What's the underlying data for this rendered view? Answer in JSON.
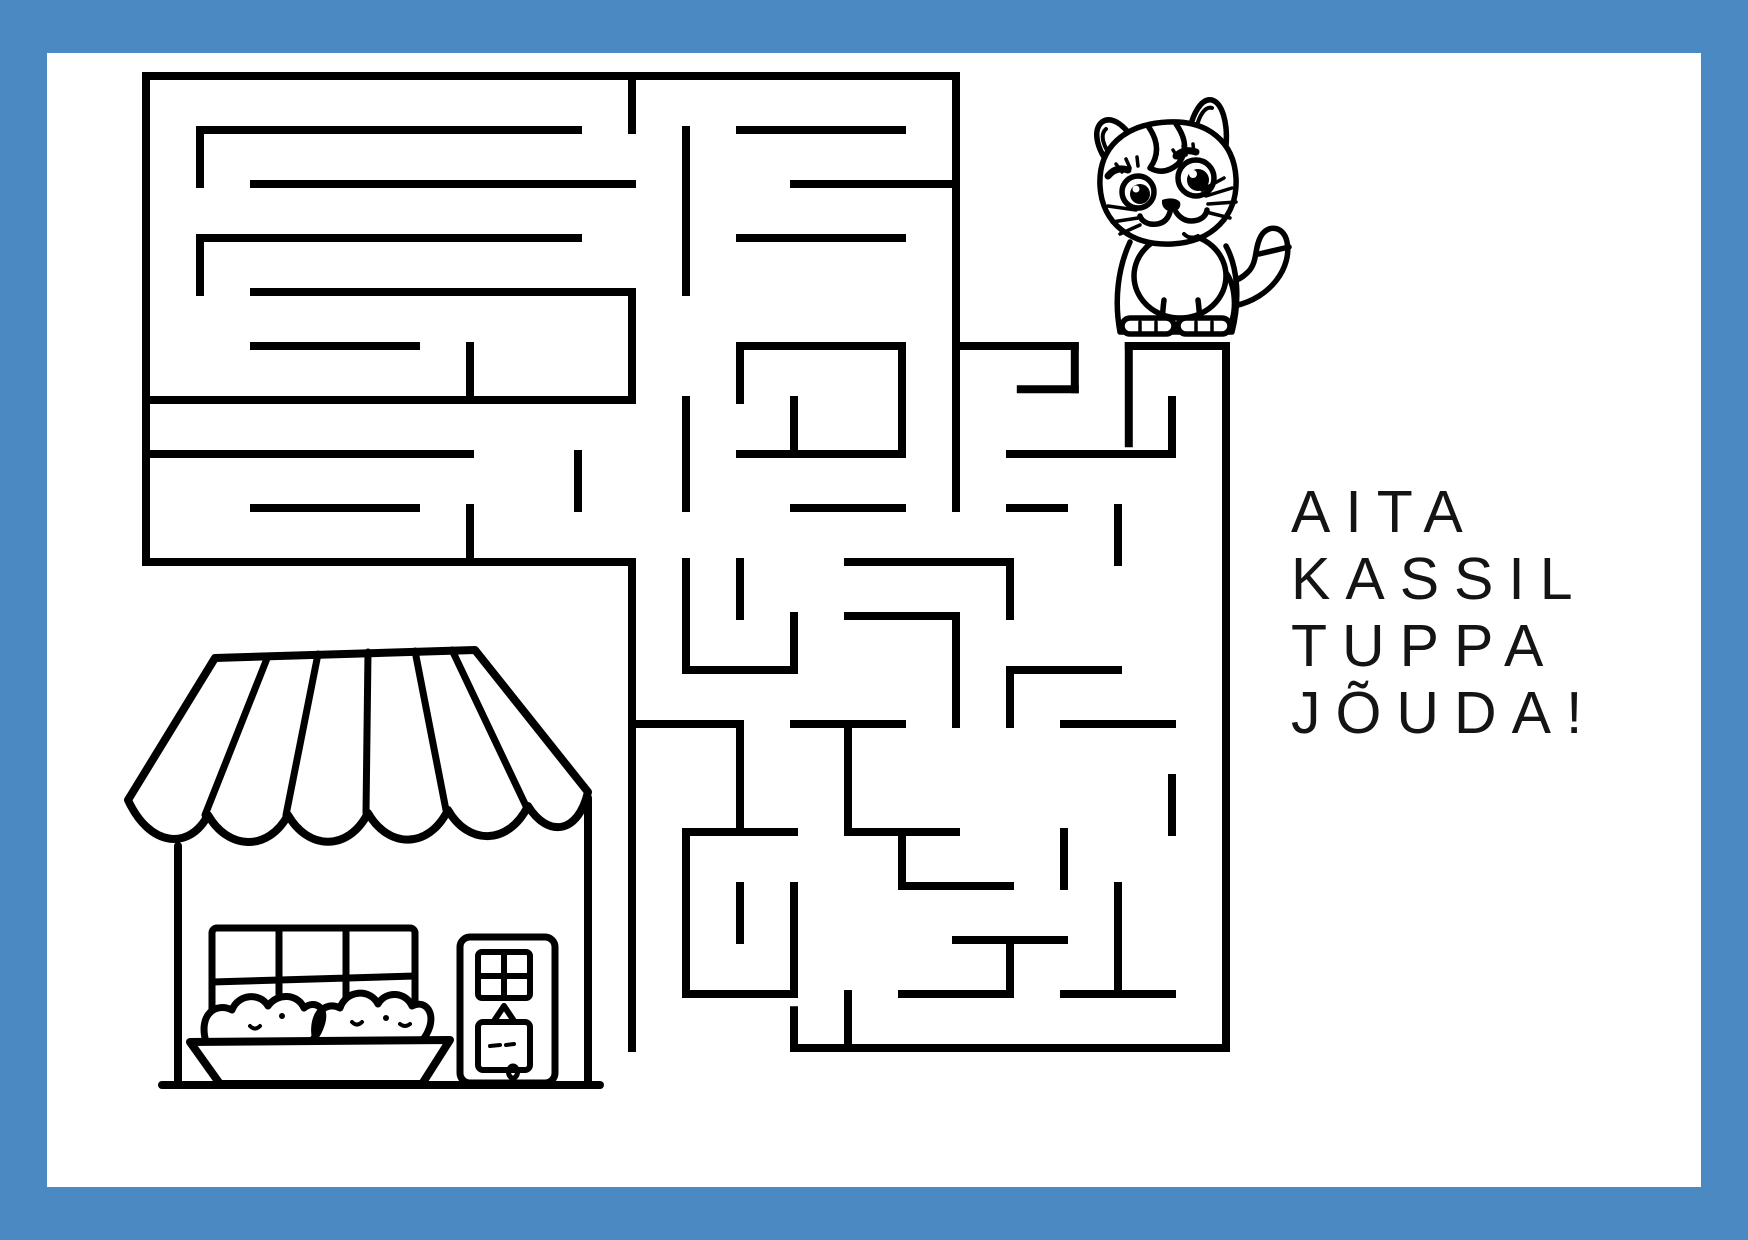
{
  "page": {
    "border_color": "#4a89c1",
    "paper_color": "#ffffff",
    "ink_color": "#000000"
  },
  "caption": {
    "lines": [
      "AITA",
      "KASSIL",
      "TUPPA",
      "JÕUDA!"
    ],
    "color": "#141414"
  },
  "illustrations": {
    "start": {
      "name": "cat",
      "position": "top-right-of-maze"
    },
    "goal": {
      "name": "shop-house",
      "position": "bottom-left-of-page"
    }
  },
  "maze": {
    "stroke": "#000000",
    "stroke_width": 8,
    "cell": 54,
    "origin_x": 146,
    "origin_y": 76,
    "entrance": "gap-in-top-edge-under-cat",
    "exit": "gap-in-bottom-edge-near-house",
    "segments": [
      [
        0,
        0,
        15,
        0
      ],
      [
        0,
        0,
        0,
        9
      ],
      [
        0,
        9,
        9,
        9
      ],
      [
        15,
        0,
        15,
        5
      ],
      [
        15,
        5,
        17.2,
        5
      ],
      [
        18.2,
        5,
        20,
        5
      ],
      [
        17.2,
        5,
        17.2,
        5.8
      ],
      [
        16.2,
        5.8,
        17.2,
        5.8
      ],
      [
        18.2,
        5,
        18.2,
        6.8
      ],
      [
        20,
        5,
        20,
        18
      ],
      [
        12,
        18,
        20,
        18
      ],
      [
        9,
        9,
        9,
        18
      ],
      [
        12,
        17.3,
        12,
        18
      ],
      [
        1,
        1,
        8,
        1
      ],
      [
        2,
        2,
        9,
        2
      ],
      [
        1,
        3,
        8,
        3
      ],
      [
        2,
        4,
        9,
        4
      ],
      [
        1,
        1,
        1,
        2
      ],
      [
        1,
        3,
        1,
        4
      ],
      [
        2,
        5,
        5,
        5
      ],
      [
        6,
        5,
        6,
        6
      ],
      [
        0,
        6,
        9,
        6
      ],
      [
        0,
        7,
        6,
        7
      ],
      [
        2,
        8,
        5,
        8
      ],
      [
        6,
        8,
        6,
        9
      ],
      [
        8,
        7,
        8,
        8
      ],
      [
        9,
        0,
        9,
        1
      ],
      [
        10,
        1,
        10,
        4
      ],
      [
        11,
        1,
        14,
        1
      ],
      [
        12,
        2,
        15,
        2
      ],
      [
        11,
        3,
        14,
        3
      ],
      [
        9,
        4,
        9,
        6
      ],
      [
        10,
        6,
        10,
        8
      ],
      [
        11,
        5,
        14,
        5
      ],
      [
        14,
        5,
        14,
        7
      ],
      [
        11,
        7,
        14,
        7
      ],
      [
        11,
        5,
        11,
        6
      ],
      [
        12,
        6,
        12,
        7
      ],
      [
        12,
        8,
        14,
        8
      ],
      [
        13,
        9,
        16,
        9
      ],
      [
        15,
        5,
        15,
        8
      ],
      [
        16,
        7,
        19,
        7
      ],
      [
        19,
        6,
        19,
        7
      ],
      [
        16,
        8,
        17,
        8
      ],
      [
        18,
        8,
        18,
        9
      ],
      [
        10,
        9,
        10,
        11
      ],
      [
        11,
        9,
        11,
        10
      ],
      [
        10,
        11,
        12,
        11
      ],
      [
        12,
        10,
        12,
        11
      ],
      [
        9,
        12,
        11,
        12
      ],
      [
        11,
        12,
        11,
        14
      ],
      [
        12,
        12,
        14,
        12
      ],
      [
        10,
        14,
        12,
        14
      ],
      [
        10,
        14,
        10,
        17
      ],
      [
        10,
        17,
        12,
        17
      ],
      [
        12,
        15,
        12,
        17
      ],
      [
        11,
        15,
        11,
        16
      ],
      [
        13,
        10,
        15,
        10
      ],
      [
        15,
        10,
        15,
        12
      ],
      [
        13,
        12,
        13,
        14
      ],
      [
        13,
        14,
        15,
        14
      ],
      [
        16,
        9,
        16,
        10
      ],
      [
        16,
        11,
        18,
        11
      ],
      [
        16,
        11,
        16,
        12
      ],
      [
        17,
        12,
        19,
        12
      ],
      [
        19,
        13,
        19,
        14
      ],
      [
        14,
        15,
        16,
        15
      ],
      [
        14,
        14,
        14,
        15
      ],
      [
        15,
        16,
        17,
        16
      ],
      [
        17,
        14,
        17,
        15
      ],
      [
        14,
        17,
        16,
        17
      ],
      [
        16,
        16,
        16,
        17
      ],
      [
        13,
        17,
        13,
        18
      ],
      [
        18,
        15,
        18,
        17
      ],
      [
        17,
        17,
        19,
        17
      ]
    ]
  }
}
